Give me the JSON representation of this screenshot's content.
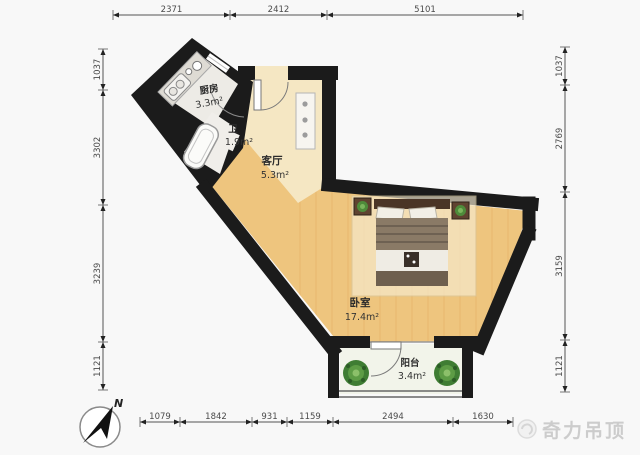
{
  "page": {
    "background": "#f7f7f7",
    "type": "floor-plan"
  },
  "floor_plan": {
    "rooms": [
      {
        "id": "kitchen",
        "name": "厨房",
        "area": "3.3m²"
      },
      {
        "id": "bath",
        "name": "卫",
        "area": "1.9m²"
      },
      {
        "id": "living",
        "name": "客厅",
        "area": "5.3m²"
      },
      {
        "id": "bedroom",
        "name": "卧室",
        "area": "17.4m²"
      },
      {
        "id": "balcony",
        "name": "阳台",
        "area": "3.4m²"
      }
    ],
    "furniture": [
      "bed",
      "nightstand-left",
      "nightstand-right",
      "bathtub",
      "kitchen-counter",
      "sink",
      "stove",
      "shoe-cabinet",
      "plant-left",
      "plant-right"
    ]
  },
  "dimension_lines": {
    "top": {
      "values": [
        "2371",
        "2412",
        "5101"
      ]
    },
    "bottom": {
      "values": [
        "1079",
        "1842",
        "931",
        "1159",
        "2494",
        "1630"
      ]
    },
    "left": {
      "values": [
        "1037",
        "3302",
        "3239",
        "1121"
      ]
    },
    "right": {
      "values": [
        "1037",
        "2769",
        "3159",
        "1121"
      ]
    }
  },
  "compass": {
    "label": "N"
  },
  "watermark": {
    "text": "奇力吊顶"
  },
  "colors": {
    "wall": "#1b1b1b",
    "wood_floor": "#eec57e",
    "hall_floor": "#f5e7c3",
    "tile_floor": "#edebe6",
    "balcony_floor": "#f2f4ea",
    "plant_green": "#3f7d33",
    "watermark_grey": "#cccccc"
  }
}
